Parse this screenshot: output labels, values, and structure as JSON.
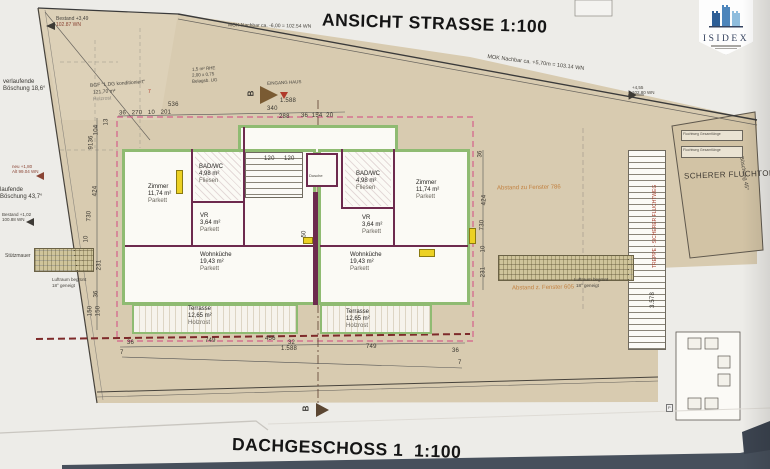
{
  "titles": {
    "top": "ANSICHT STRASSE 1:100",
    "bottom": "DACHGESCHOSS 1  1:100"
  },
  "logo": {
    "name": "ISIDEX"
  },
  "annotations": {
    "bestand_top": "Bestand +3,49",
    "bestand_top_wn": "102.87 WN",
    "mok_left": "MOK Nachbar ca. -6,00 = 102.54 WN",
    "mok_right": "MOK Nachbar ca. +5,70m = 103.14 WN",
    "level_right": "+4,55",
    "level_right_wn": "102.80 WN",
    "boeschung_1a": "verlaufende",
    "boeschung_1b": "Böschung 18,6°",
    "boeschung_2a": "laufende",
    "boeschung_2b": "Böschung 43,7°",
    "marker_1a": "neu +1,80",
    "marker_1b": "Alt 99.04 WN",
    "marker_2a": "Bestand +1,02",
    "marker_2b": "100.88 WN",
    "bgf_1": "BGF \"1.DG konditioniert\"",
    "bgf_2": "121,70 m²",
    "bgf_3": "Holzrost",
    "rhe_1": "1,5 m² RHE",
    "rhe_2": "2,00 x 0,75",
    "rhe_3": "Belagsb. UG",
    "eingang": "EINGANG HAUS",
    "stuetzmauer": "Stützmauer",
    "luftraum_1": "Luftraum begrünt",
    "luftraum_2": "18° geneigt",
    "abstand_1": "Abstand zu Fenster 786",
    "abstand_2": "Abstand z. Fenster 605",
    "fluchtort": "SCHERER FLUCHTORT",
    "boeschung_45": "Böschung 45°",
    "treppe": "TREPPE - SICHERER FLUCHTWEG",
    "fluchtweg_1": "Fluchtweg Gesamtlänge",
    "fluchtweg_2": "Fluchtweg Gesamtlänge",
    "dusche": "Dusche",
    "section_b": "B",
    "p_mark": "P"
  },
  "rooms": {
    "left": [
      {
        "name": "Zimmer",
        "area": "11,74 m²",
        "floor": "Parkett"
      },
      {
        "name": "BAD/WC",
        "area": "4,98 m²",
        "floor": "Fliesen"
      },
      {
        "name": "VR",
        "area": "3,64 m²",
        "floor": "Parkett"
      },
      {
        "name": "Wohnküche",
        "area": "19,43 m²",
        "floor": "Parkett"
      },
      {
        "name": "Terrasse",
        "area": "12,65 m²",
        "floor": "Holzrost"
      }
    ],
    "right": [
      {
        "name": "BAD/WC",
        "area": "4,98 m²",
        "floor": "Fliesen"
      },
      {
        "name": "Zimmer",
        "area": "11,74 m²",
        "floor": "Parkett"
      },
      {
        "name": "VR",
        "area": "3,64 m²",
        "floor": "Parkett"
      },
      {
        "name": "Wohnküche",
        "area": "19,43 m²",
        "floor": "Parkett"
      },
      {
        "name": "Terrasse",
        "area": "12,65 m²",
        "floor": "Holzrost"
      }
    ]
  },
  "dims": {
    "t536": "536",
    "tchain": "36   270   10   201",
    "t1588": "1.588",
    "t340": "340",
    "t288": "288",
    "tright": "36  154  20",
    "t120": "120     120",
    "l13": "13",
    "l104": "104",
    "l36": "36",
    "l91": "91",
    "l424": "424",
    "l730": "730",
    "l10": "10",
    "l231": "231",
    "l36b": "36",
    "l150a": "150",
    "l150b": "150",
    "r36": "36",
    "r424": "424",
    "r730": "730",
    "r10": "10",
    "r231": "231",
    "r3578": "3.578",
    "m50": "50",
    "b36": "36",
    "b749": "749",
    "b456": "456",
    "b32": "32",
    "b7": "7",
    "b1588": "1.588",
    "b749r": "749",
    "b36r": "36",
    "b7r": "7"
  }
}
